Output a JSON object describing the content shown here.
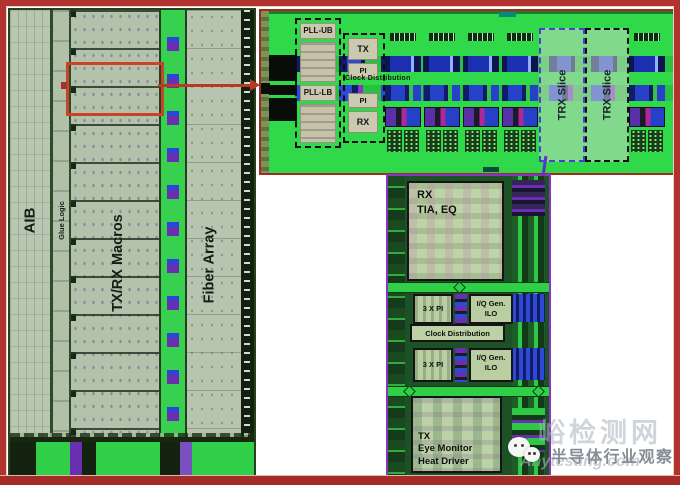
{
  "figure": {
    "type": "chip-die-annotated-figure",
    "colors": {
      "frame_red": "#b23230",
      "callout_red": "#c8432a",
      "bank_green": "#2fd94a",
      "die_sage": "#b7c3ae",
      "label_tan": "#ccc8b0",
      "lightbox_green": "#bed4a8",
      "slice_border_purple": "#8a35c0",
      "trx_left_dash": "#4a3fd8",
      "watermark_gray": "#868e95"
    }
  },
  "die_overview": {
    "aib_label": "AIB",
    "glue_logic_label": "Glue Logic",
    "txrx_macros_label": "TX/RX Macros",
    "fiber_array_label": "Fiber Array"
  },
  "bank_zoom": {
    "pll_ub_label": "PLL-UB",
    "pll_lb_label": "PLL-LB",
    "tx_label": "TX",
    "pi_top_label": "PI",
    "clock_distribution_label": "Clock Distribution",
    "pi_bottom_label": "PI",
    "rx_label": "RX",
    "trx_slice_left_label": "TRX Slice",
    "trx_slice_right_label": "TRX Slice"
  },
  "slice_detail": {
    "rx_line1": "RX",
    "rx_line2": "TIA, EQ",
    "pi_row1_label": "3 X PI",
    "iq_row1_line1": "I/Q Gen.",
    "iq_row1_line2": "ILO",
    "clock_distribution_label": "Clock Distribution",
    "pi_row2_label": "3 X PI",
    "iq_row2_line1": "I/Q Gen.",
    "iq_row2_line2": "ILO",
    "tx_line1": "TX",
    "tx_line2": "Eye Monitor",
    "tx_line3": "Heat Driver"
  },
  "watermarks": {
    "wechat_icon": "wechat-logo",
    "account_name": "半导体行业观察",
    "site_name": "峪检测网",
    "site_url": "Anytesting.com"
  }
}
